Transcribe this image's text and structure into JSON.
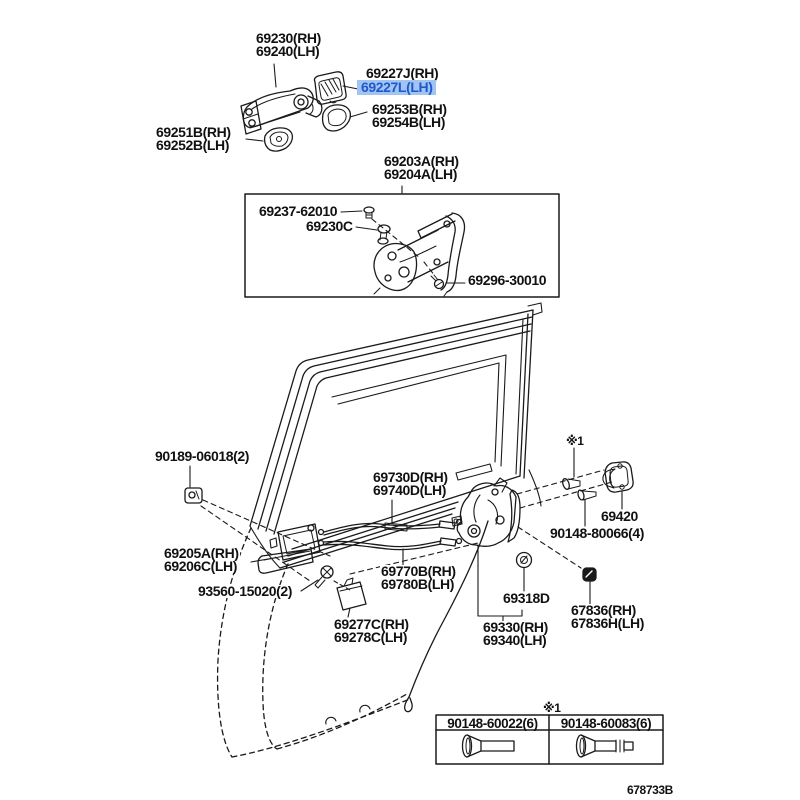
{
  "diagram_code": "678733B",
  "colors": {
    "line": "#1a1a1a",
    "highlight_bg": "#a2c4f0",
    "highlight_text": "#2058cf"
  },
  "labels": [
    {
      "text": "69230(RH)\n69240(LH)"
    },
    {
      "text": "69227J(RH)"
    },
    {
      "text": "69227L(LH)"
    },
    {
      "text": "69253B(RH)\n69254B(LH)"
    },
    {
      "text": "69251B(RH)\n69252B(LH)"
    },
    {
      "text": "69203A(RH)\n69204A(LH)"
    },
    {
      "text": "69237-62010"
    },
    {
      "text": "69230C"
    },
    {
      "text": "69296-30010"
    },
    {
      "text": "90189-06018(2)"
    },
    {
      "text": "69730D(RH)\n69740D(LH)"
    },
    {
      "text": "69420"
    },
    {
      "text": "90148-80066(4)"
    },
    {
      "text": "69205A(RH)\n69206C(LH)"
    },
    {
      "text": "69770B(RH)\n69780B(LH)"
    },
    {
      "text": "93560-15020(2)"
    },
    {
      "text": "69318D"
    },
    {
      "text": "67836(RH)\n67836H(LH)"
    },
    {
      "text": "69277C(RH)\n69278C(LH)"
    },
    {
      "text": "69330(RH)\n69340(LH)"
    },
    {
      "text": "※1"
    },
    {
      "text": "※1"
    }
  ],
  "table": {
    "headers": [
      "90148-60022(6)",
      "90148-60083(6)"
    ]
  }
}
